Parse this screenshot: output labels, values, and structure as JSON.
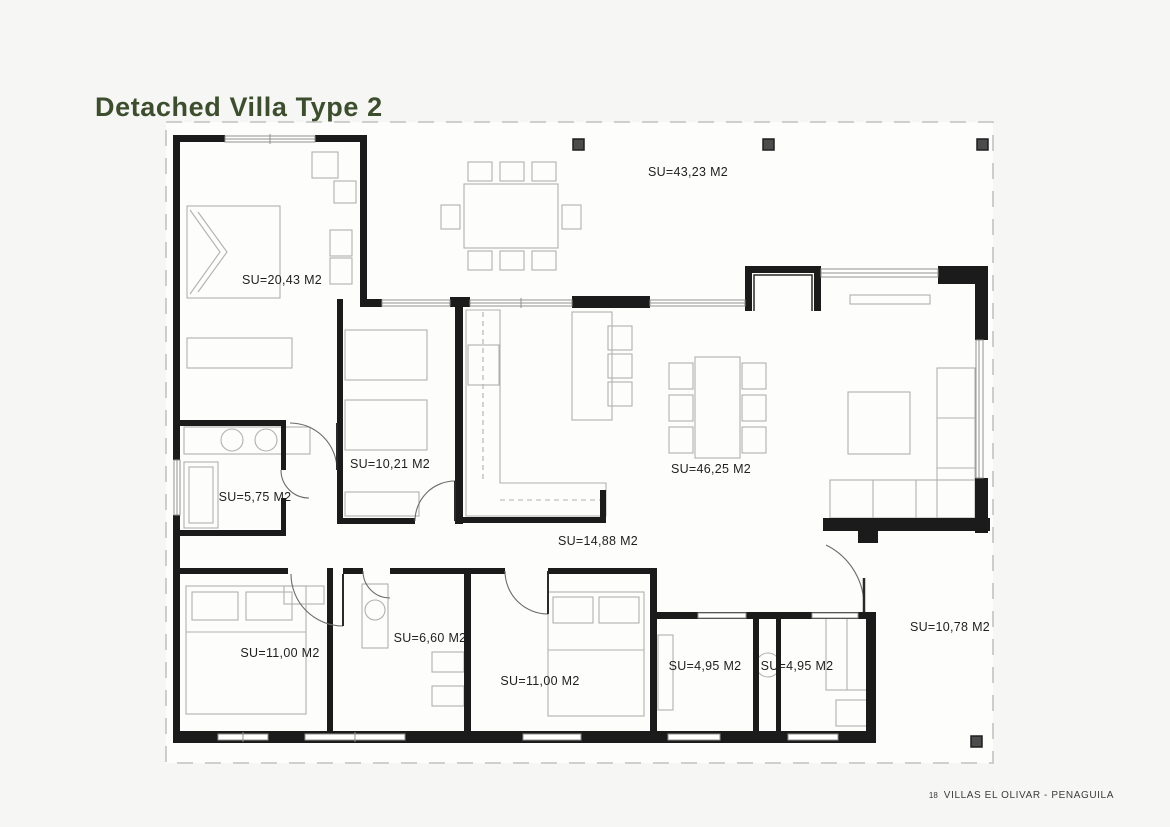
{
  "page": {
    "title": "Detached Villa Type 2"
  },
  "footer": {
    "page_number": "18",
    "project": "VILLAS EL OLIVAR - PENAGUILA"
  },
  "colors": {
    "title_green": "#3c4e2d",
    "wall_black": "#1b1b1b",
    "furniture_gray": "#b1b1af",
    "boundary_gray": "#c2c2c0",
    "pillar_gray": "#4c4c4c",
    "page_bg": "#f6f6f4",
    "plan_bg": "#fdfdfc"
  },
  "plan": {
    "rooms": [
      {
        "id": "terrace",
        "label": "SU=43,23 M2"
      },
      {
        "id": "master-bedroom",
        "label": "SU=20,43 M2"
      },
      {
        "id": "bedroom-2",
        "label": "SU=10,21 M2"
      },
      {
        "id": "bathroom-1",
        "label": "SU=5,75 M2"
      },
      {
        "id": "living-dining",
        "label": "SU=46,25 M2"
      },
      {
        "id": "kitchen",
        "label": "SU=14,88 M2"
      },
      {
        "id": "bedroom-3",
        "label": "SU=11,00 M2"
      },
      {
        "id": "bathroom-2",
        "label": "SU=6,60 M2"
      },
      {
        "id": "bedroom-4",
        "label": "SU=11,00 M2"
      },
      {
        "id": "storage-1",
        "label": "SU=4,95 M2"
      },
      {
        "id": "storage-2",
        "label": "SU=4,95 M2"
      },
      {
        "id": "side-porch",
        "label": "SU=10,78 M2"
      }
    ]
  }
}
